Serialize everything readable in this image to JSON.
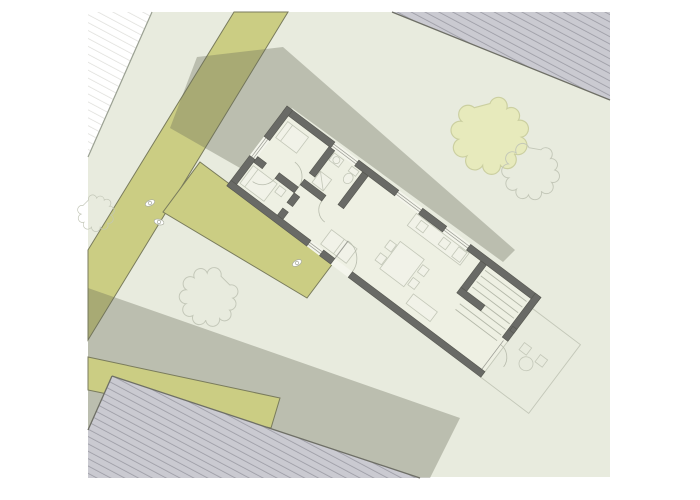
{
  "meta": {
    "type": "architectural-site-plan",
    "building_rotation_deg": 37,
    "canvas": {
      "width": 700,
      "height": 500
    }
  },
  "scene": {
    "trees_total": 4,
    "trees_filled": 1,
    "trees_outline": 3,
    "people_figures": 3,
    "hatched_parcels": 3,
    "paths": 3,
    "shadow_areas": 2
  },
  "colors": {
    "page_bg": "#ffffff",
    "site": "#e8ebde",
    "site_edge": "#9aa092",
    "road": "#cbcd83",
    "road_edge": "#797b5c",
    "shadow": "rgba(104,106,90,0.35)",
    "hatch_fill": "#cacad1",
    "hatch_line": "#9a9aa3",
    "hatch_edge": "#6e6f66",
    "pale_line": "#dcdcd8",
    "wall": "#696a66",
    "wall_edge": "#55564f",
    "floor": "#eef0e3",
    "glass": "#9b9c94",
    "glass_bg": "#f4f5ec",
    "fur_stroke": "#c3c7b8",
    "fur_fill": "#f1f2e8",
    "arc": "#b8bcad",
    "stair": "#b3b7a8",
    "tree_fill": "#e7eabc",
    "tree_stroke": "#cbcfa0",
    "tree_outline": "#c3c7b8",
    "person_fill": "#ffffff",
    "person_stroke": "#a9ac9e",
    "none": "none"
  }
}
